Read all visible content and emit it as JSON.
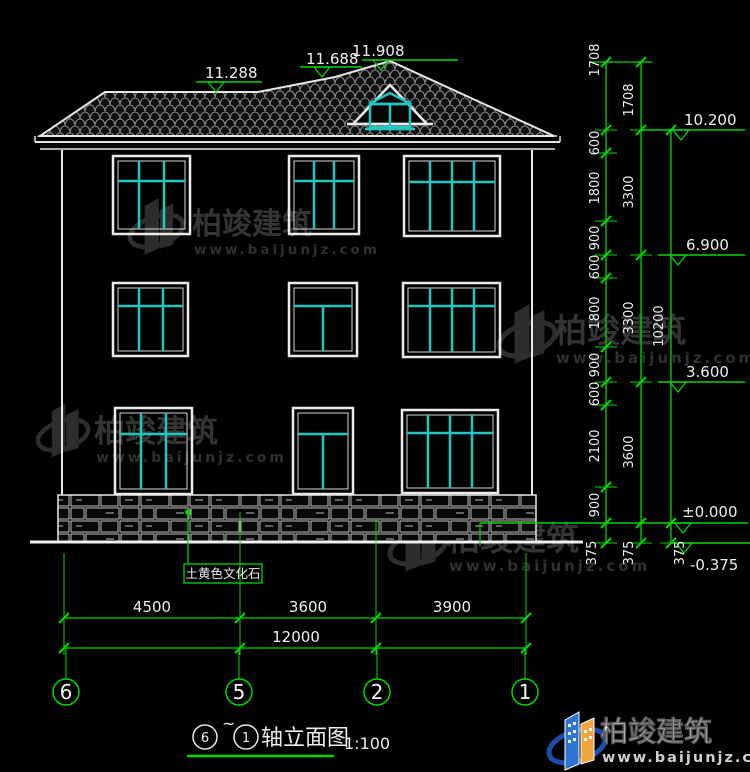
{
  "drawing": {
    "title": {
      "axis_start": "6",
      "tilde": "~",
      "axis_end": "1",
      "label": "轴立面图",
      "scale": "1:100"
    },
    "roof_levels": {
      "left": "11.288",
      "mid": "11.688",
      "top": "11.908"
    },
    "right_dims": {
      "col1": [
        "1708",
        "600",
        "1800",
        "900",
        "600",
        "1800",
        "900",
        "600",
        "2100",
        "900",
        "375"
      ],
      "col2": [
        "1708",
        "3300",
        "3300",
        "3600",
        "375"
      ],
      "col3": {
        "total": "10200",
        "offset": "375"
      },
      "levels": [
        "10.200",
        "6.900",
        "3.600",
        "±0.000",
        "-0.375"
      ]
    },
    "bottom_dims": {
      "segments": [
        "4500",
        "3600",
        "3900"
      ],
      "total": "12000"
    },
    "axes": [
      "6",
      "5",
      "2",
      "1"
    ],
    "stone_label": "土黄色文化石"
  },
  "watermark": {
    "name": "柏竣建筑",
    "url": "www.baijunjz.com"
  },
  "footer": {
    "brand": "柏竣建筑",
    "url": "www.baijunjz.com"
  },
  "colors": {
    "dim_green": "#00d800",
    "window_teal": "#1fc8be",
    "line_white": "#e9e9e9",
    "background": "#000000",
    "logo_blue": "#2f74d0",
    "logo_orange": "#f0a43a"
  }
}
